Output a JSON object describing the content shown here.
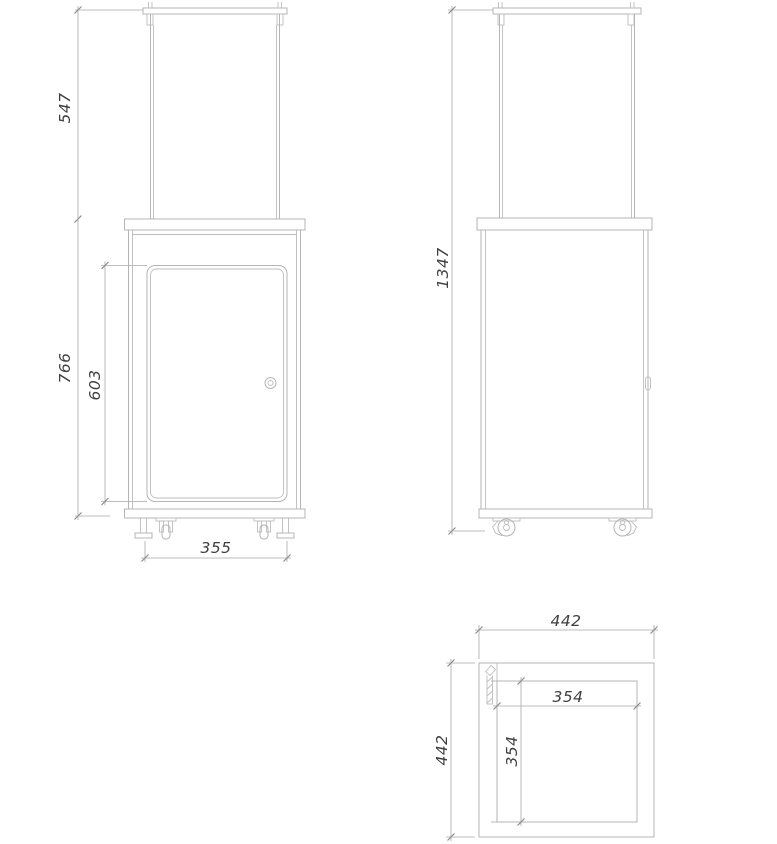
{
  "colors": {
    "geometry": "#b5b5b5",
    "detail": "#bdbdbd",
    "dimension": "#a9a9a9",
    "tick": "#8c8c8c",
    "text": "#3f3f3f",
    "background": "#ffffff"
  },
  "dimensions": {
    "front_view": {
      "glass_section_height": "547",
      "base_cabinet_height": "766",
      "door_height": "603",
      "feet_spacing_width": "355"
    },
    "side_view": {
      "overall_height": "1347"
    },
    "bottom_view": {
      "overall_width": "442",
      "overall_depth": "442",
      "inner_frame_width": "354",
      "inner_frame_depth": "354"
    }
  }
}
